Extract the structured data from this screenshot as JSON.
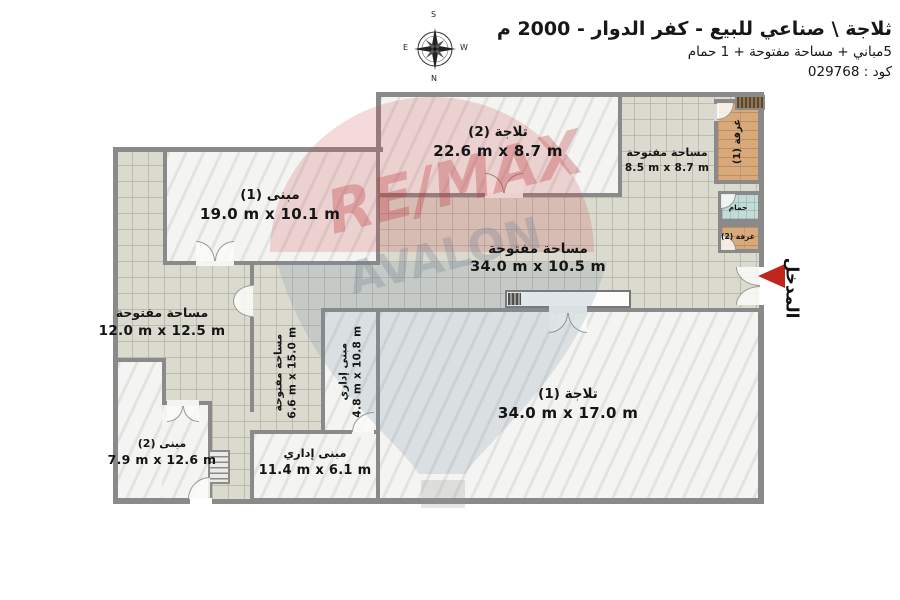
{
  "header": {
    "title": "ثلاجة \\ صناعي للبيع - كفر الدوار - 2000 م",
    "subtitle": "5مباني + مساحة مفتوحة + 1 حمام",
    "code": "كود : 029768"
  },
  "compass": {
    "top": "S",
    "bottom": "N",
    "left": "E",
    "right": "W"
  },
  "watermark": {
    "brand": "RE/MAX",
    "office": "AVALON"
  },
  "entrance": {
    "label": "المدخل"
  },
  "rooms": [
    {
      "id": "building-1",
      "name": "مبنى (1)",
      "dims": "19.0 m x 10.1 m"
    },
    {
      "id": "fridge-2",
      "name": "تلاجة (2)",
      "dims": "22.6 m x 8.7 m"
    },
    {
      "id": "open-area-ne",
      "name": "مساحة مفتوحة",
      "dims": "8.5 m x 8.7 m"
    },
    {
      "id": "room-1",
      "name": "غرفة (1)",
      "dims": ""
    },
    {
      "id": "bathroom",
      "name": "حمام",
      "dims": ""
    },
    {
      "id": "room-2",
      "name": "غرفة (2)",
      "dims": ""
    },
    {
      "id": "open-area-mid",
      "name": "مساحة مفتوحة",
      "dims": "34.0 m x 10.5 m"
    },
    {
      "id": "open-area-west",
      "name": "مساحة مفتوحة",
      "dims": "12.0 m x 12.5 m"
    },
    {
      "id": "open-area-strip",
      "name": "مساحة مفتوحة",
      "dims": "6.6 m x 15.0 m"
    },
    {
      "id": "admin-small",
      "name": "مبنى إداري",
      "dims": "4.8 m x 10.8 m"
    },
    {
      "id": "admin-large",
      "name": "مبنى إداري",
      "dims": "11.4 m x 6.1 m"
    },
    {
      "id": "fridge-1",
      "name": "تلاجة (1)",
      "dims": "34.0 m x 17.0 m"
    },
    {
      "id": "building-2",
      "name": "مبنى (2)",
      "dims": "7.9 m x 12.6 m"
    }
  ]
}
